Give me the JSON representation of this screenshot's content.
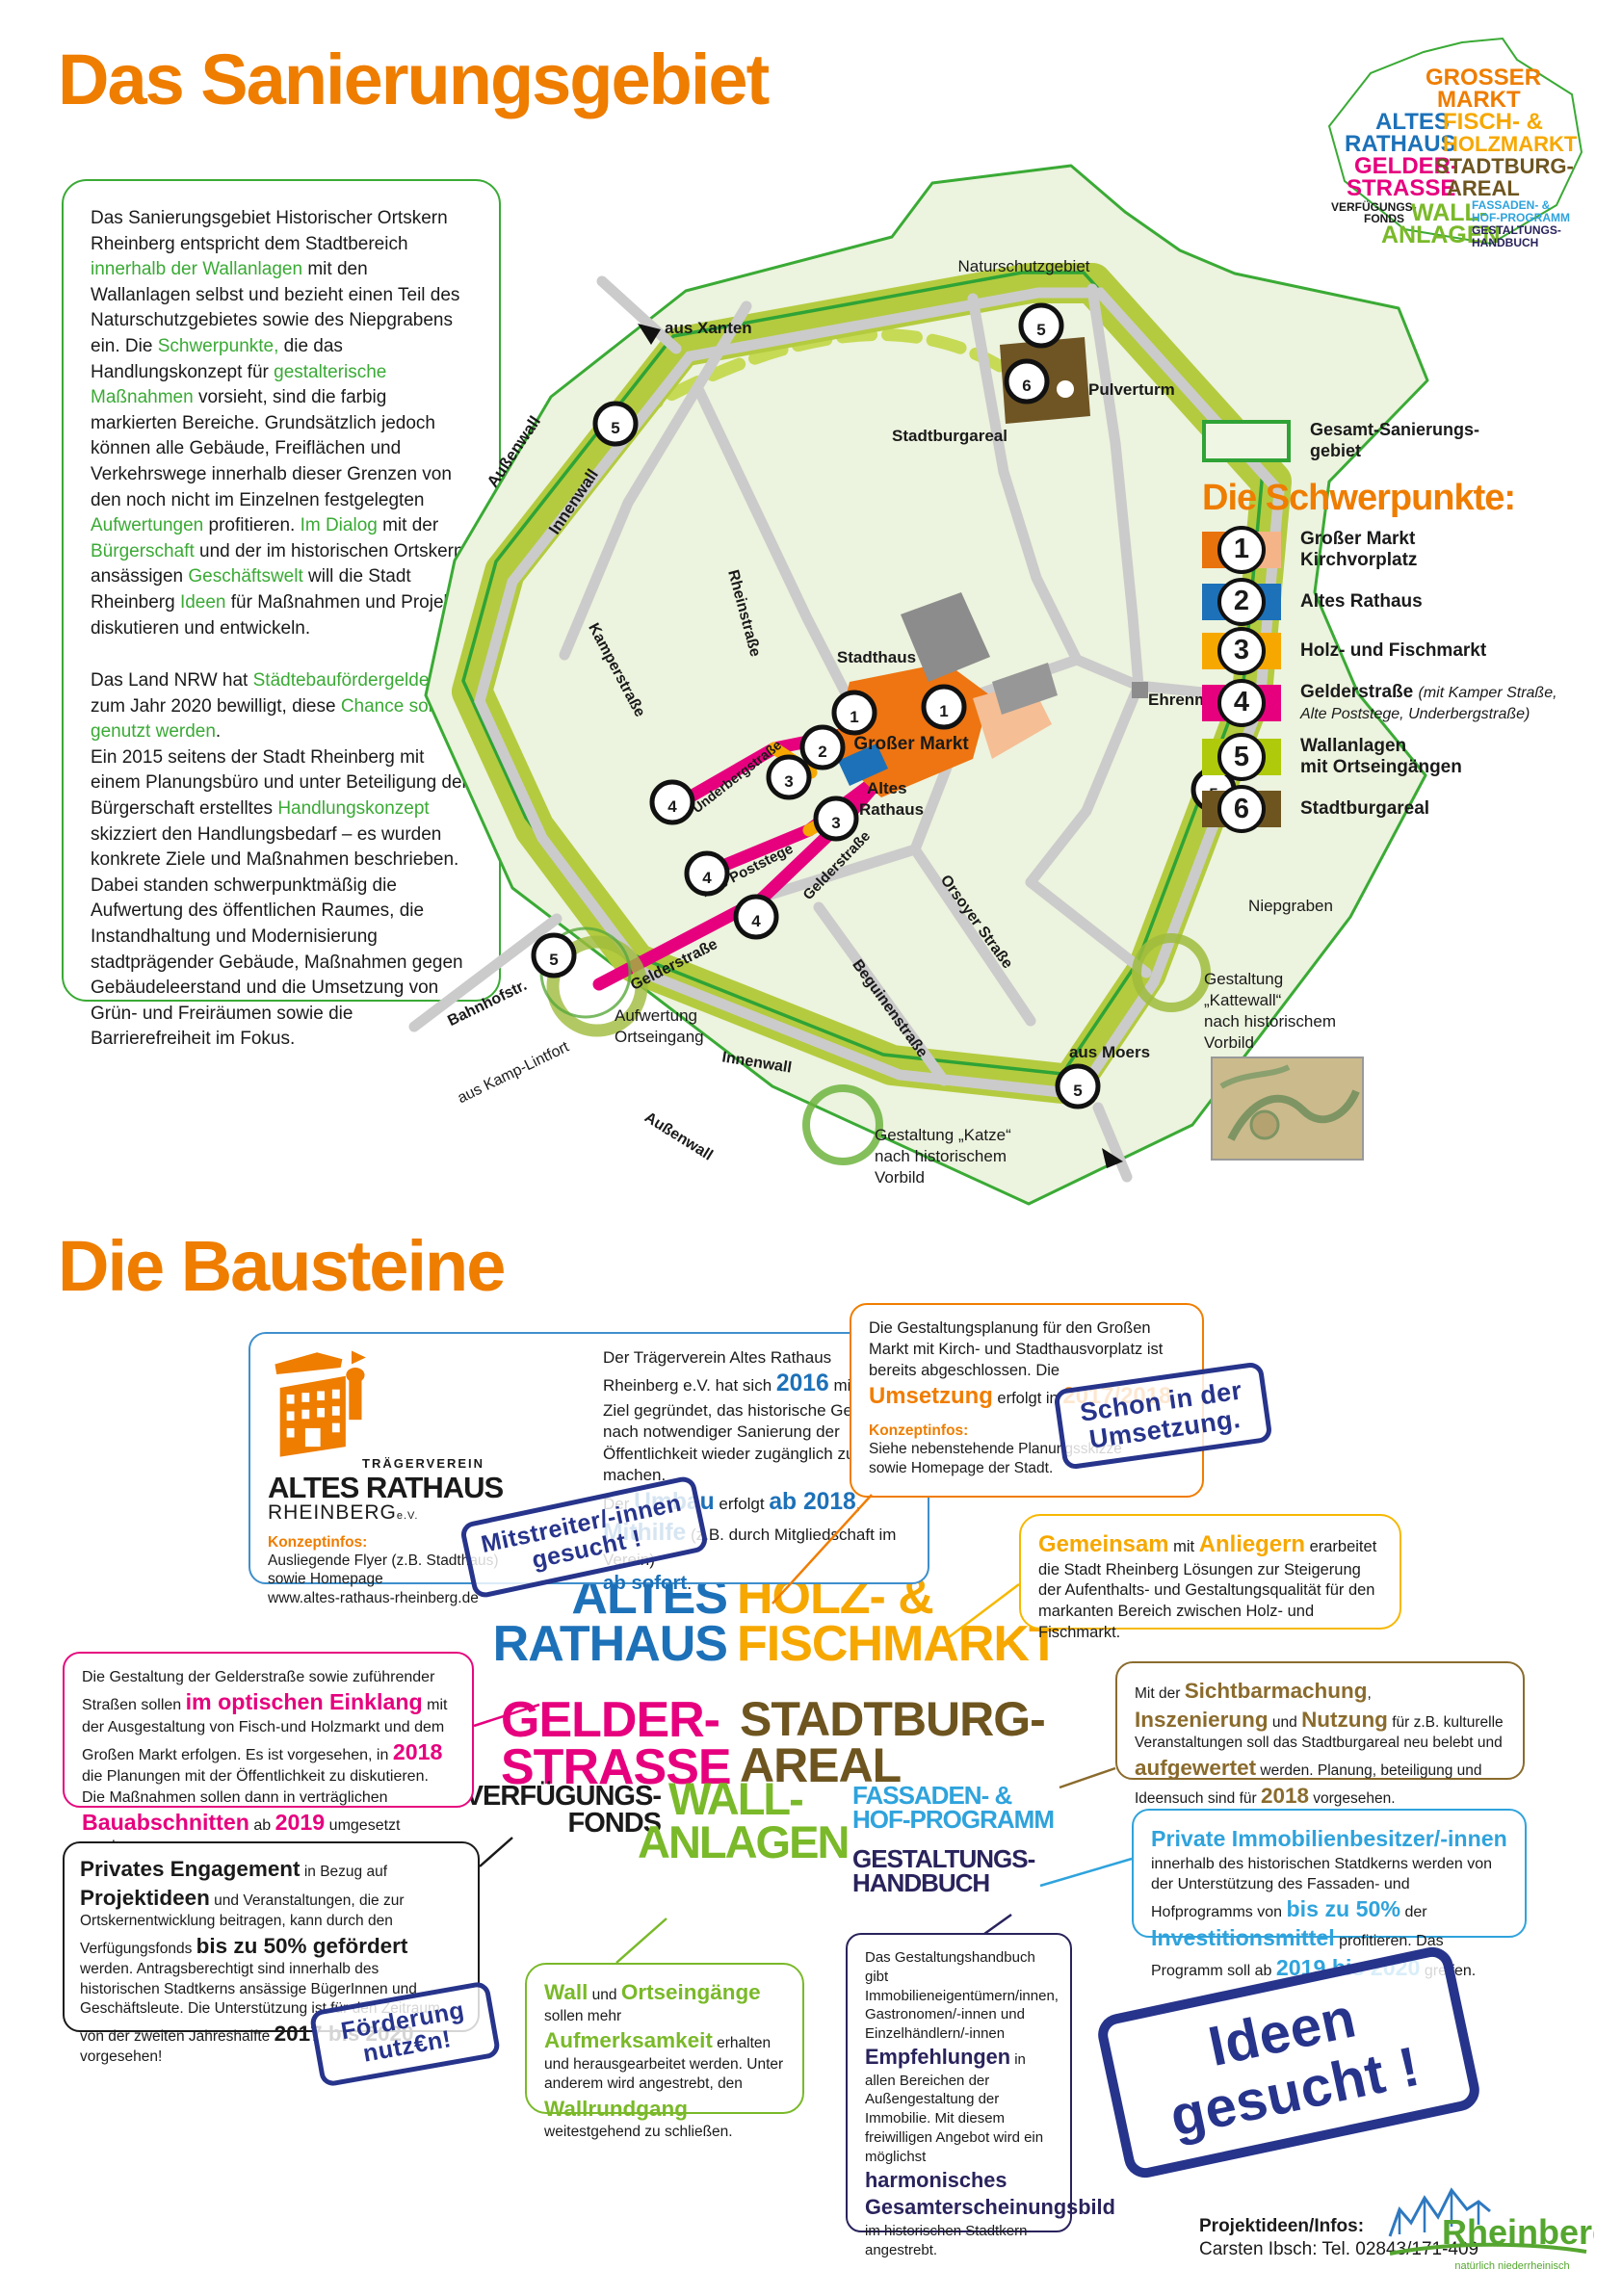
{
  "title": "Das Sanierungsgebiet",
  "section2_title": "Die Bausteine",
  "colors": {
    "accent_orange": "#EE7D00",
    "green": "#3AAA35",
    "olive_wall": "#B4CB3F",
    "pink": "#E6007E",
    "blue": "#1D71B8",
    "light_blue": "#2FA3DC",
    "amber": "#F6A800",
    "brown": "#6E5520",
    "navy": "#29235C",
    "stamp_blue": "#27348B"
  },
  "intro": {
    "p1": {
      "s1": "Das Sanierungsgebiet Historischer Ortskern Rheinberg entspricht dem Stadtbereich ",
      "s2": "innerhalb der Wallanlagen",
      "s3": " mit den Wallanlagen selbst und bezieht einen Teil des Naturschutzgebietes sowie des Niepgrabens ein. Die ",
      "s4": "Schwerpunkte,",
      "s5": " die das Handlungskonzept für ",
      "s6": "gestalterische Maßnahmen",
      "s7": " vorsieht, sind die farbig markierten Bereiche. Grundsätzlich jedoch können alle Gebäude, Freiflächen und Verkehrswege innerhalb dieser Grenzen von den noch nicht im Einzelnen festgelegten ",
      "s8": "Aufwertungen",
      "s9": " profitieren. ",
      "s10": "Im Dialog",
      "s11": " mit der ",
      "s12": "Bürgerschaft",
      "s13": " und der im historischen Ortskern ansässigen ",
      "s14": "Geschäftswelt",
      "s15": " will die Stadt Rheinberg ",
      "s16": "Ideen",
      "s17": " für Maßnahmen und Projekte diskutieren und entwickeln."
    },
    "p2a": {
      "s1": "Das Land NRW hat ",
      "s2": "Städtebaufördergelder",
      "s3": " bis zum Jahr 2020 bewilligt, diese ",
      "s4": "Chance soll genutzt werden",
      "s5": "."
    },
    "p2b": {
      "s1": "Ein 2015 seitens der Stadt Rheinberg mit einem Planungsbüro und unter Beteiligung der Bürgerschaft erstelltes ",
      "s2": "Handlungskonzept",
      "s3": " skizziert den Handlungsbedarf – es wurden konkrete Ziele und Maßnahmen beschrieben."
    },
    "p2c": {
      "s1": "Dabei standen schwerpunktmäßig die Aufwertung des öffentlichen Raumes, die Instandhaltung und Modernisierung stadtprägender Gebäude, Maßnahmen gegen Gebäudeleerstand und die Umsetzung von Grün- und Freiräumen sowie die Barrierefreiheit im Fokus."
    }
  },
  "logo_cloud": {
    "grosser": "GROSSER",
    "markt": "MARKT",
    "altes": "ALTES",
    "rathaus": "RATHAUS",
    "fisch": "FISCH- &",
    "holzmarkt": "HOLZMARKT",
    "gelder": "GELDER-",
    "strasse": "STRASSE",
    "stadtburg": "STADTBURG-",
    "areal": "AREAL",
    "verfuegungs": "VERFÜGUNGS-",
    "fonds": "FONDS",
    "wall": "WALL-",
    "anlagen": "ANLAGEN",
    "fassaden": "FASSADEN- &",
    "hof": "HOF-PROGRAMM",
    "gestaltungs": "GESTALTUNGS-",
    "handbuch": "HANDBUCH"
  },
  "map": {
    "labels": {
      "naturschutzgebiet": "Naturschutzgebiet",
      "aus_xanten": "aus Xanten",
      "pulverturm": "Pulverturm",
      "stadtburgareal": "Stadtburgareal",
      "aussenwall_top": "Außenwall",
      "innenwall_top": "Innenwall",
      "rheinstrasse": "Rheinstraße",
      "kamperstrasse": "Kamperstraße",
      "stadthaus": "Stadthaus",
      "grosser_markt": "Großer Markt",
      "altes_1": "Altes",
      "altes_2": "Rathaus",
      "underbergstrasse": "Underbergstraße",
      "alte_poststege": "Alte Poststege",
      "gelderstrasse_a": "Gelderstraße",
      "gelderstrasse_b": "Gelderstraße",
      "ehrenmal": "Ehrenmal",
      "orsoyer": "Orsoyer Straße",
      "beguinen": "Beguinenstraße",
      "niepgraben": "Niepgraben",
      "bahnhofstr": "Bahnhofstr.",
      "aus_kamp": "aus Kamp-Lintfort",
      "aufwertung_1": "Aufwertung",
      "aufwertung_2": "Ortseingang",
      "innenwall_bottom": "Innenwall",
      "aussenwall_bottom": "Außenwall",
      "aus_moers": "aus Moers",
      "katze_1": "Gestaltung „Katze“",
      "katze_2": "nach historischem",
      "katze_3": "Vorbild",
      "kattewall_1": "Gestaltung",
      "kattewall_2": "„Kattewall“",
      "kattewall_3": "nach historischem",
      "kattewall_4": "Vorbild"
    },
    "badge_numbers": {
      "n1": "1",
      "n2": "2",
      "n3": "3",
      "n4": "4",
      "n5": "5",
      "n6": "6"
    }
  },
  "legend": {
    "swatch_label_1": "Gesamt-Sanierungs-",
    "swatch_label_2": "gebiet",
    "heading": "Die Schwerpunkte:",
    "items": [
      {
        "num": "1",
        "line1": "Großer Markt",
        "line2": "Kirchvorplatz"
      },
      {
        "num": "2",
        "line1": "Altes Rathaus"
      },
      {
        "num": "3",
        "line1": "Holz- und Fischmarkt"
      },
      {
        "num": "4",
        "line1": "Gelderstraße",
        "italic": "(mit Kamper Straße, Alte Poststege, Underbergstraße)"
      },
      {
        "num": "5",
        "line1": "Wallanlagen",
        "line2": "mit Ortseingängen"
      },
      {
        "num": "6",
        "line1": "Stadtburgareal"
      }
    ]
  },
  "cards": {
    "c1": {
      "logo_t1": "TRÄGERVEREIN",
      "logo_t2": "ALTES RATHAUS",
      "logo_t3": "RHEINBERG",
      "logo_t4": "e.V.",
      "konzept_h": "Konzeptinfos:",
      "k1": "Ausliegende Flyer (z.B. Stadthaus)",
      "k2": "sowie Homepage",
      "k3": "www.altes-rathaus-rheinberg.de",
      "s1": "Der Trägerverein Altes Rathaus Rheinberg e.V. hat sich ",
      "s2": "2016",
      "s3": " mit dem Ziel gegründet, das historische Gebäude nach notwendiger Sanierung der Öffentlichkeit wieder zugänglich zu machen.",
      "s4": "Der ",
      "s5": "Umbau",
      "s6": " erfolgt ",
      "s7": "ab 2018",
      "s8": ", ",
      "s9": "Mithilfe",
      "s10": " (z.B. durch Mitgliedschaft im Verein) ",
      "s11": "ab sofort",
      "s12": "."
    },
    "c2": {
      "s1": "Die Gestaltungsplanung für den Großen Markt mit Kirch- und Stadthausvorplatz ist bereits abgeschlossen. Die ",
      "s2": "Umsetzung",
      "s3": " erfolgt in ",
      "s4": "2017/2018",
      "s5": ".",
      "konzept_h": "Konzeptinfos:",
      "k1": "Siehe nebenstehende Planungsskizze",
      "k2": "sowie Homepage der Stadt."
    },
    "c3": {
      "s1": "Gemeinsam",
      "s2": " mit ",
      "s3": "Anliegern",
      "s4": " erarbeitet die Stadt Rheinberg Lösungen zur Steigerung der Aufenthalts- und Gestaltungsqualität für den markanten Bereich zwischen Holz- und Fischmarkt."
    },
    "c4": {
      "s1": "Die Gestaltung der Gelderstraße sowie zuführender Straßen sollen ",
      "s2": "im optischen Einklang",
      "s3": " mit der Ausgestaltung von Fisch-und Holzmarkt und dem Großen Markt erfolgen. Es ist vorgesehen, in ",
      "s4": "2018",
      "s5": " die Planungen mit der Öffentlichkeit zu diskutieren. Die Maßnahmen sollen dann in verträglichen ",
      "s6": "Bauabschnitten",
      "s7": " ab ",
      "s8": "2019",
      "s9": " umgesetzt werden."
    },
    "c5": {
      "s1": "Mit der ",
      "s2": "Sichtbarmachung",
      "s3": ", ",
      "s4": "Inszenierung",
      "s5": " und ",
      "s6": "Nutzung",
      "s7": " für z.B. kulturelle Veranstaltungen soll das Stadtburgareal neu belebt und ",
      "s8": "aufgewertet",
      "s9": " werden. Planung, beteiligung und Ideensuch sind für ",
      "s10": "2018",
      "s11": " vorgesehen."
    },
    "c6": {
      "s1": "Privates Engagement",
      "s2": " in Bezug auf ",
      "s3": "Projektideen",
      "s4": " und Veranstaltungen, die zur Ortskernentwicklung beitragen, kann durch den Verfügungsfonds ",
      "s5": "bis zu 50% gefördert",
      "s6": " werden. Antragsberechtigt sind innerhalb des historischen Stadtkerns ansässige BügerInnen und Geschäftsleute. Die Unterstützung ist für den Zeitraum von der zweiten Jahreshälfte ",
      "s7": "2017 bis 2020",
      "s8": " vorgesehen!"
    },
    "c7": {
      "s1": "Wall",
      "s2": " und ",
      "s3": "Ortseingänge",
      "s4": " sollen mehr ",
      "s5": "Aufmerksamkeit",
      "s6": " erhalten und herausgearbeitet werden. Unter anderem wird angestrebt, den ",
      "s7": "Wallrundgang",
      "s8": " weitestgehend zu schließen."
    },
    "c8": {
      "s1": "Das Gestaltungshandbuch gibt Immobilieneigentümern/innen, Gastronomen/-innen und Einzelhändlern/-innen ",
      "s2": "Empfehlungen",
      "s3": " in allen Bereichen der Außengestaltung der Immobilie. Mit diesem freiwilligen Angebot wird ein möglichst ",
      "s4": "harmonisches Gesamterscheinungsbild",
      "s5": " im historischen Stadtkern angestrebt."
    },
    "c9": {
      "s1": "Private Immobilienbesitzer/-innen",
      "s2": " innerhalb des historischen Statdkerns werden von der Unterstützung des Fassaden- und Hofprogramms von ",
      "s3": "bis zu 50%",
      "s4": " der ",
      "s5": "Investitionsmittel",
      "s6": " profitieren. Das Programm soll ab ",
      "s7": "2019 bis 2020",
      "s8": " greifen."
    }
  },
  "cloud": {
    "grosser": "GROSSER",
    "markt": "MARKT",
    "altes": "ALTES",
    "rathaus": "RATHAUS",
    "holz": "HOLZ- &",
    "fischmarkt": "FISCHMARKT",
    "gelder": "GELDER-",
    "strasse": "STRASSE",
    "stadtburg": "STADTBURG-",
    "areal": "AREAL",
    "verfuegungs": "VERFÜGUNGS-",
    "fonds": "FONDS",
    "wall": "WALL-",
    "anlagen": "ANLAGEN",
    "fassaden": "FASSADEN- &",
    "hof": "HOF-PROGRAMM",
    "gestaltungs": "GESTALTUNGS-",
    "handbuch": "HANDBUCH"
  },
  "stamps": {
    "m1": "Mitstreiter/-innen",
    "m2": "gesucht !",
    "u1": "Schon in der",
    "u2": "Umsetzung.",
    "f1": "Förderung",
    "f2": "nutz€n!",
    "i1": "Ideen",
    "i2": "gesucht !"
  },
  "footer": {
    "info_h": "Projektideen/Infos:",
    "info": "Carsten Ibsch: Tel. 02843/171-409",
    "city_logo": "Rheinberg",
    "city_tagline": "natürlich niederrheinisch"
  }
}
